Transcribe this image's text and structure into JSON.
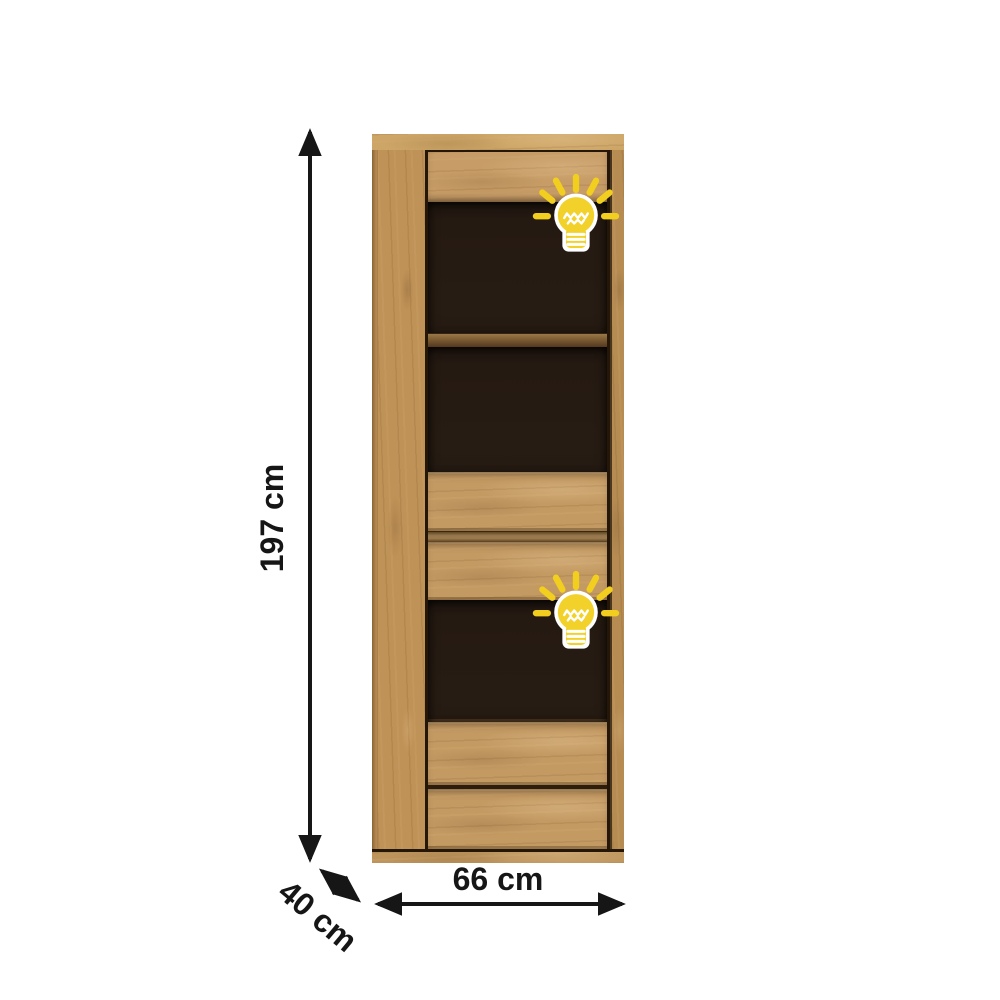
{
  "figure": {
    "dimensions": {
      "height": "197 cm",
      "width": "66 cm",
      "depth": "40 cm"
    },
    "icons": [
      "lightbulb-icon",
      "lightbulb-icon"
    ],
    "colors": {
      "background": "#ffffff",
      "arrow": "#161616",
      "label_text": "#161616",
      "wood_light": "#cda567",
      "wood_mid": "#c49a63",
      "wood_dark": "#8a6336",
      "interior_dark": "#241a12",
      "shelf": "#7d5c30",
      "bulb_yellow": "#f2d02a",
      "bulb_outline": "#ffffff"
    }
  }
}
